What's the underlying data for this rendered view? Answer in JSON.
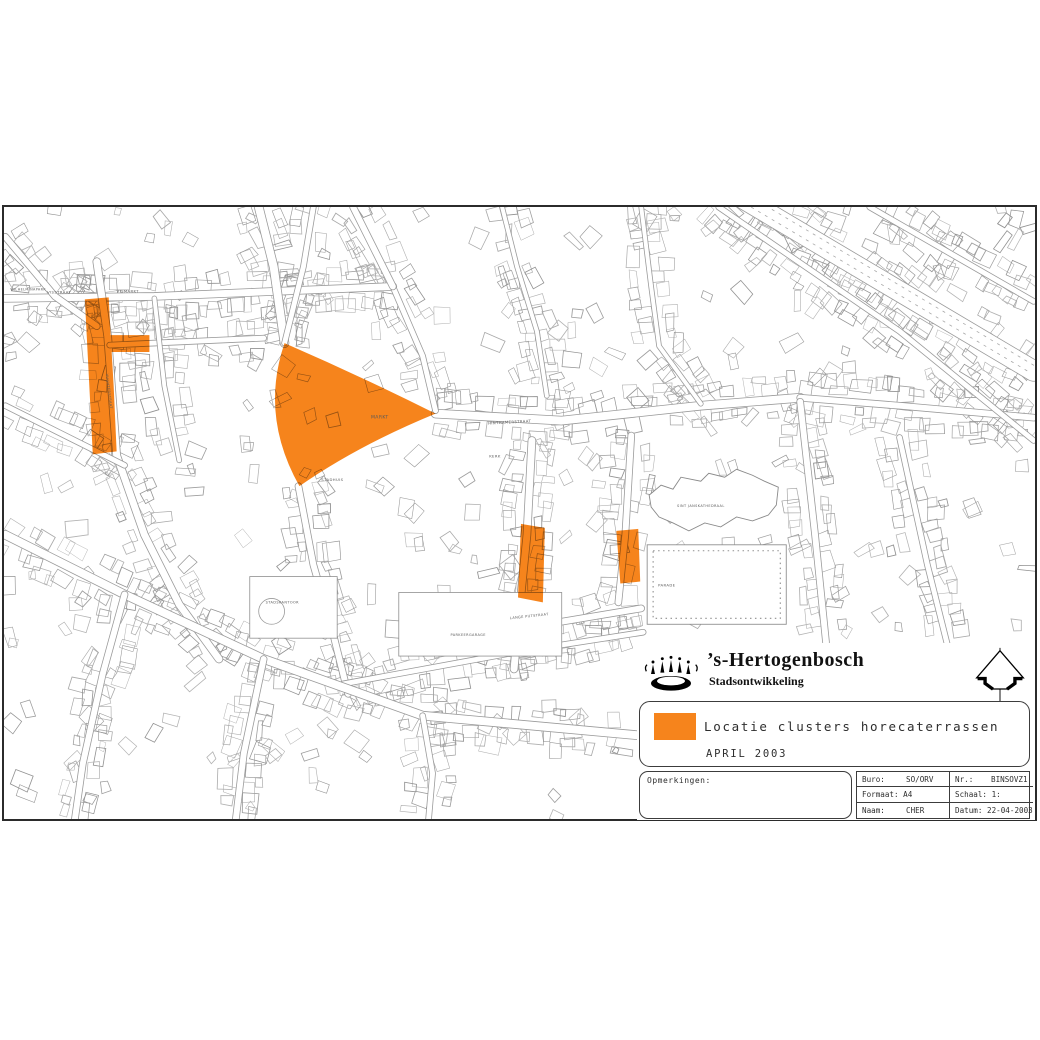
{
  "org": {
    "name": "’s-Hertogenbosch",
    "department": "Stadsontwikkeling"
  },
  "legend": {
    "swatch_color": "#F6841C",
    "label": "Locatie clusters horecaterrassen",
    "date": "APRIL 2003"
  },
  "remarks": {
    "label": "Opmerkingen:"
  },
  "titleblock": {
    "buro_label": "Buro:",
    "buro_value": "SO/ORV",
    "nr_label": "Nr.:",
    "nr_value": "BINSOVZ1",
    "formaat_label": "Formaat:",
    "formaat_value": "A4",
    "schaal_label": "Schaal:",
    "schaal_value": "1:",
    "naam_label": "Naam:",
    "naam_value": "CHER",
    "datum_label": "Datum:",
    "datum_value": "22-04-2003"
  },
  "map": {
    "highlight_color": "#F6841C",
    "zones": [
      {
        "id": "cluster-1",
        "path": "M80,93 L104,91 L106,129 L145,129 L145,146 L107,146 L109,180 L112,246 L88,249 L84,170 Z"
      },
      {
        "id": "cluster-2",
        "path": "M281,137 Q357,170 433,208 Q355,240 296,281 Q256,210 281,137 Z"
      },
      {
        "id": "cluster-3",
        "path": "M519,319 L543,323 L541,398 L516,393 Z"
      },
      {
        "id": "cluster-4",
        "path": "M615,326 L637,324 L639,377 L619,379 Z"
      }
    ],
    "labels": [
      {
        "text": "WILHELMINAPARK",
        "x": 5,
        "y": 84,
        "r": 0,
        "s": 3.4
      },
      {
        "text": "VISSTRAAT",
        "x": 42,
        "y": 87,
        "r": 0,
        "s": 3.8
      },
      {
        "text": "VISMARKT",
        "x": 112,
        "y": 86,
        "r": 0,
        "s": 3.8
      },
      {
        "text": "VUGHTERSTRAAT",
        "x": 101,
        "y": 168,
        "r": 83,
        "s": 3.5
      },
      {
        "text": "MARKT",
        "x": 368,
        "y": 213,
        "r": 0,
        "s": 4.6
      },
      {
        "text": "STADHUIS",
        "x": 318,
        "y": 276,
        "r": 0,
        "s": 3.8
      },
      {
        "text": "HINTHAMERSTRAAT",
        "x": 486,
        "y": 219,
        "r": -3,
        "s": 3.8
      },
      {
        "text": "KERK",
        "x": 487,
        "y": 252,
        "r": 0,
        "s": 3.8
      },
      {
        "text": "SINT JANSKATHEDRAAL",
        "x": 676,
        "y": 302,
        "r": 0,
        "s": 3.5
      },
      {
        "text": "PARADE",
        "x": 657,
        "y": 382,
        "r": 0,
        "s": 3.8
      },
      {
        "text": "STADSKANTOOR",
        "x": 262,
        "y": 399,
        "r": 0,
        "s": 3.5
      },
      {
        "text": "PARKEERGARAGE",
        "x": 448,
        "y": 432,
        "r": 0,
        "s": 3.5
      },
      {
        "text": "LANGE PUTSTRAAT",
        "x": 508,
        "y": 415,
        "r": -6,
        "s": 3.5
      }
    ]
  }
}
